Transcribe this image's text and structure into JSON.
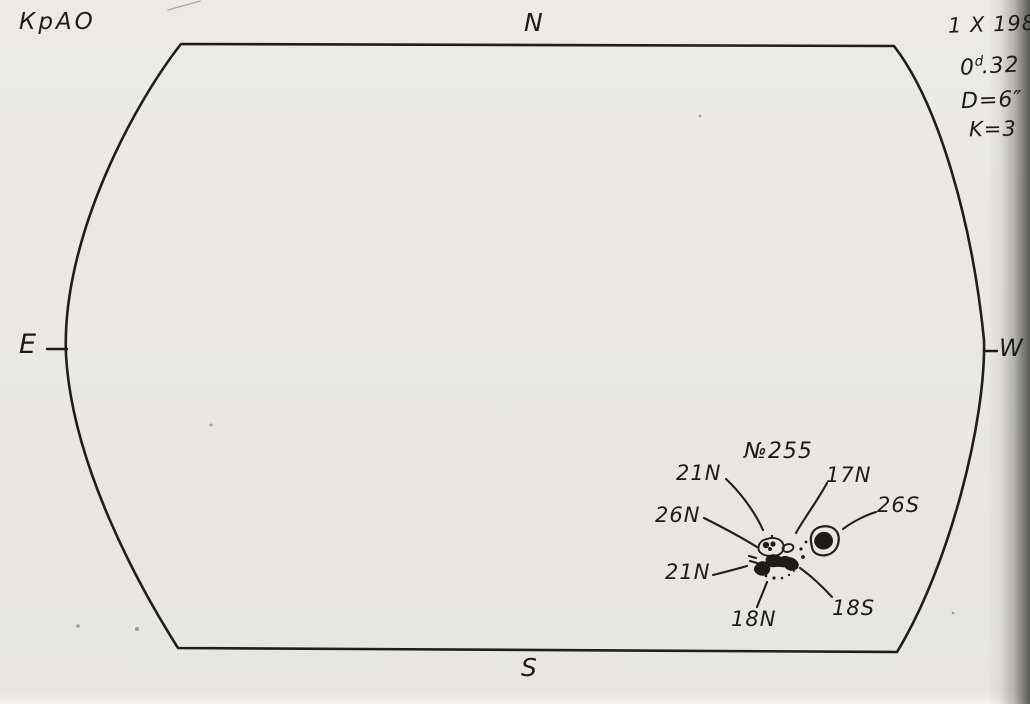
{
  "header": {
    "observatory": "КрАО",
    "date": "1 X 1983",
    "day_prefix": "0",
    "day_sup": "d",
    "day_suffix": ".32",
    "diameter": "D=6″",
    "seeing": "K=3"
  },
  "compass": {
    "north": "N",
    "south": "S",
    "east": "E",
    "west": "W"
  },
  "group": {
    "number": "№255",
    "labels": {
      "n21_upper": "21N",
      "n17": "17N",
      "s26": "26S",
      "n26": "26N",
      "n21_lower": "21N",
      "n18": "18N",
      "s18": "18S"
    }
  },
  "colors": {
    "ink": "#1d1c1a",
    "paper": "#e9e8e5",
    "edge_shadow": "#2a2a28"
  }
}
